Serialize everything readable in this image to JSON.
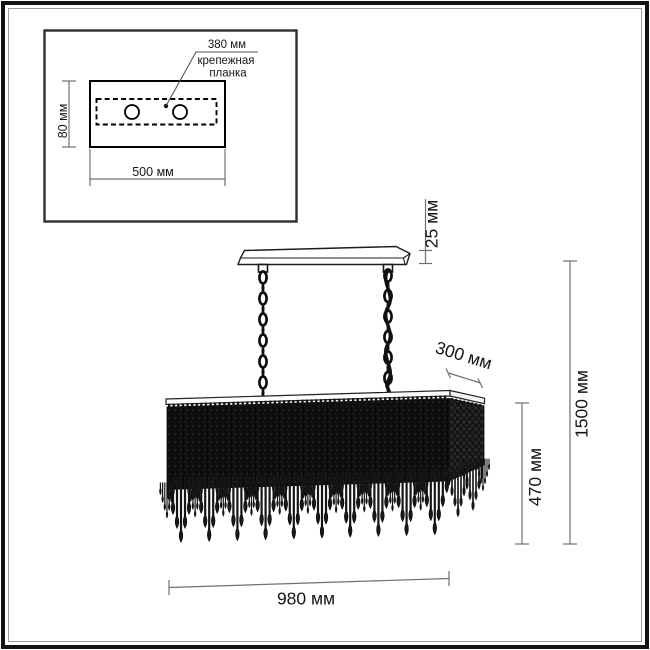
{
  "diagram": {
    "inset": {
      "bracket_width_label": "380 мм",
      "bracket_name_line1": "крепежная",
      "bracket_name_line2": "планка",
      "plate_height_label": "80 мм",
      "plate_width_label": "500 мм"
    },
    "fixture": {
      "canopy_thickness_label": "25 мм",
      "shade_depth_label": "300 мм",
      "shade_height_label": "470 мм",
      "total_height_label": "1500 мм",
      "shade_width_label": "980 мм"
    },
    "colors": {
      "line": "#1c1c1c",
      "dimension": "#707070",
      "curtain": "#101010"
    }
  }
}
